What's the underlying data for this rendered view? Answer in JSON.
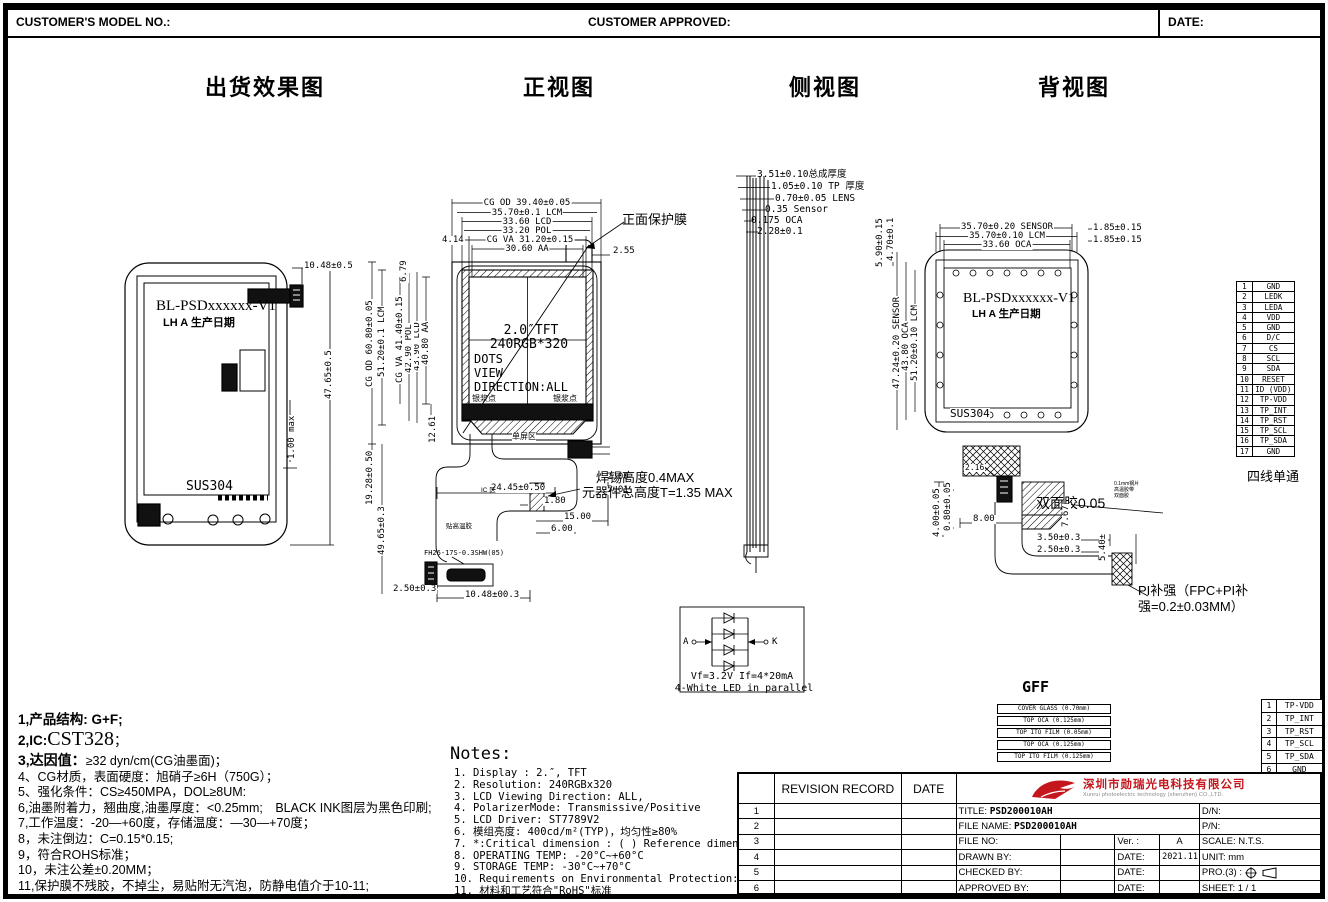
{
  "header": {
    "model_no": "CUSTOMER'S MODEL NO.:",
    "approved": "CUSTOMER APPROVED:",
    "date": "DATE:"
  },
  "section_titles": {
    "shipping": "出货效果图",
    "front": "正视图",
    "side": "侧视图",
    "back": "背视图"
  },
  "shipping": {
    "model": "BL-PSDxxxxxx-V1",
    "date_code": "LH A 生产日期",
    "steel": "SUS304",
    "dim_top": "10.48±0.5",
    "dim_height": "47.65±0.5",
    "dim_step": "1.00 max"
  },
  "front": {
    "top_dims": [
      "CG OD 39.40±0.05",
      "35.70±0.1 LCM",
      "33.60 LCD",
      "33.20 POL",
      "CG VA 31.20±0.15",
      "30.60 AA"
    ],
    "dim_4_14": "4.14",
    "dim_2_55": "2.55",
    "protect_film": "正面保护膜",
    "left_dims": [
      "CG OD 60.80±0.05",
      "51.20±0.1 LCM",
      "43.90 LCD",
      "42.90 POL",
      "CG VA 41.40±0.15",
      "40.80 AA"
    ],
    "dim_6_79": "6.79",
    "dim_12_61": "12.61",
    "dim_19_28": "19.28±0.50",
    "dim_49_65": "49.65±0.3",
    "screen": {
      "l1": "2.0″TFT",
      "l2": "240RGB*320",
      "l3": "DOTS",
      "l4": "VIEW",
      "l5": "DIRECTION:ALL"
    },
    "silver_left": "银浆点",
    "silver_right": "银浆点",
    "bottom_zone": "单屏区",
    "dim_2_00": "2.00",
    "dim_5_01": "5.01",
    "dim_24_45": "24.45±0.50",
    "dim_1_80": "1.80",
    "solder_note": "焊锡高度0.4MAX",
    "component_note": "元器件总高度T=1.35 MAX",
    "dim_15": "15.00",
    "dim_6": "6.00",
    "connector_label": "FH26-17S-0.3SHW(05)",
    "dim_10_48": "10.48±00.3",
    "dim_2_50": "2.50±0.3",
    "ic_label": "IC 区",
    "tape_label": "贴高温胶"
  },
  "side": {
    "dims": [
      "3.51±0.10总成厚度",
      "1.05±0.10 TP 厚度",
      "0.70±0.05 LENS",
      "0.35 Sensor",
      "0.175 OCA",
      "2.28±0.1"
    ]
  },
  "back": {
    "top_dims": [
      "35.70±0.20 SENSOR",
      "35.70±0.10 LCM",
      "33.60 OCA"
    ],
    "dim_1_85_a": "1.85±0.15",
    "dim_1_85_b": "1.85±0.15",
    "dim_5_90": "5.90±0.15",
    "dim_4_70": "4.70±0.1",
    "left_dims": [
      "47.24±0.20 SENSOR",
      "43.80 OCA",
      "51.20±0.10 LCM"
    ],
    "model": "BL-PSDxxxxxx-V1",
    "date_code": "LH A 生产日期",
    "steel": "SUS304",
    "dim_2_16": "2.16",
    "dim_0_80": "0.80±0.05",
    "dim_4_00": "4.00±0.05",
    "dim_8_00": "8.00",
    "tape_label": "双面胶0.05",
    "dim_7_67": "7.67",
    "stack_small": [
      "0.1mm钢片",
      "高温胶带",
      "双面胶"
    ],
    "dim_3_50": "3.50±0.3",
    "dim_2_50": "2.50±0.3",
    "dim_5_40": "5.40±",
    "pi_note1": "PI补强（FPC+PI补",
    "pi_note2": "强=0.2±0.03MM）"
  },
  "pin_table": {
    "rows": [
      [
        "1",
        "GND"
      ],
      [
        "2",
        "LEDK"
      ],
      [
        "3",
        "LEDA"
      ],
      [
        "4",
        "VDD"
      ],
      [
        "5",
        "GND"
      ],
      [
        "6",
        "D/C"
      ],
      [
        "7",
        "CS"
      ],
      [
        "8",
        "SCL"
      ],
      [
        "9",
        "SDA"
      ],
      [
        "10",
        "RESET"
      ],
      [
        "11",
        "ID (VDD)"
      ],
      [
        "12",
        "TP-VDD"
      ],
      [
        "13",
        "TP_INT"
      ],
      [
        "14",
        "TP_RST"
      ],
      [
        "15",
        "TP_SCL"
      ],
      [
        "16",
        "TP_SDA"
      ],
      [
        "17",
        "GND"
      ]
    ],
    "caption": "四线单通"
  },
  "tp_table": {
    "rows": [
      [
        "1",
        "TP-VDD"
      ],
      [
        "2",
        "TP_INT"
      ],
      [
        "3",
        "TP_RST"
      ],
      [
        "4",
        "TP_SCL"
      ],
      [
        "5",
        "TP_SDA"
      ],
      [
        "6",
        "GND"
      ]
    ]
  },
  "led": {
    "a": "A",
    "k": "K",
    "line1": "Vf=3.2V If=4*20mA",
    "line2": "4-White LED in parallel"
  },
  "gff": {
    "title": "GFF",
    "layers": [
      "COVER GLASS (0.70mm)",
      "TOP OCA (0.125mm)",
      "TOP ITO FILM (0.05mm)",
      "TOP OCA (0.125mm)",
      "TOP ITO FILM (0.125mm)"
    ]
  },
  "notes_cn": {
    "l1": "1,产品结构: G+F;",
    "l2_prefix": "2,IC:",
    "l2_big": "CST328",
    "l2_suffix": "；",
    "l3_prefix": "3,达因值：",
    "l3_rest": "≥32 dyn/cm(CG油墨面)；",
    "items": [
      "4、CG材质，表面硬度：旭硝子≥6H（750G）；",
      "5、强化条件：CS≥450MPA，DOL≥8UM:",
      "6,油墨附着力，翘曲度,油墨厚度：<0.25mm;　BLACK INK图层为黑色印刷;",
      "7,工作温度：-20—+60度，存储温度：—30—+70度；",
      "8，未注倒边：C=0.15*0.15;",
      "9，符合ROHS标准；",
      "10，未注公差±0.20MM；",
      "11,保护膜不残胶，不掉尘，易贴附无汽泡，防静电值介于10-11;"
    ]
  },
  "notes_en": {
    "title": "Notes:",
    "items": [
      "1. Display : 2.″,  TFT",
      "2. Resolution: 240RGBx320",
      "3. LCD Viewing Direction: ALL,",
      "4. PolarizerMode: Transmissive/Positive",
      "5. LCD Driver: ST7789V2",
      "6. 模组亮度: 400cd/m²(TYP)，均匀性≥80%",
      "7. *:Critical dimension : ( ) Reference dimension;",
      "8. OPERATING TEMP: -20°C~+60°C",
      "9. STORAGE TEMP: -30°C~+70°C",
      "10. Requirements on Environmental Protection: ROHS",
      "11. 材料和工艺符合\"RoHS\"标准"
    ]
  },
  "title_block": {
    "revision_record": "REVISION RECORD",
    "date_col": "DATE",
    "row_nums": [
      "1",
      "2",
      "3",
      "4",
      "5",
      "6"
    ],
    "company_cn": "深圳市勋瑞光电科技有限公司",
    "company_en": "Xunrui photoelectric technology (shenzhen) CO.,LTD.",
    "title_label": "TITLE:",
    "title_value": "PSD200010AH",
    "file_name_label": "FILE NAME:",
    "file_name_value": "PSD200010AH",
    "dn": "D/N:",
    "pn": "P/N:",
    "file_no": "FILE NO:",
    "ver_label": "Ver. :",
    "ver_value": "A",
    "scale": "SCALE: N.T.S.",
    "drawn": "DRAWN BY:",
    "date1": "DATE:",
    "date1_value": "2021.11.24",
    "unit": "UNIT: mm",
    "checked": "CHECKED BY:",
    "date2": "DATE:",
    "pro": "PRO.(3) :",
    "approved": "APPROVED BY:",
    "date3": "DATE:",
    "sheet": "SHEET: 1 / 1"
  },
  "colors": {
    "line": "#000000",
    "brand_red": "#c4161c",
    "paper": "#ffffff"
  }
}
